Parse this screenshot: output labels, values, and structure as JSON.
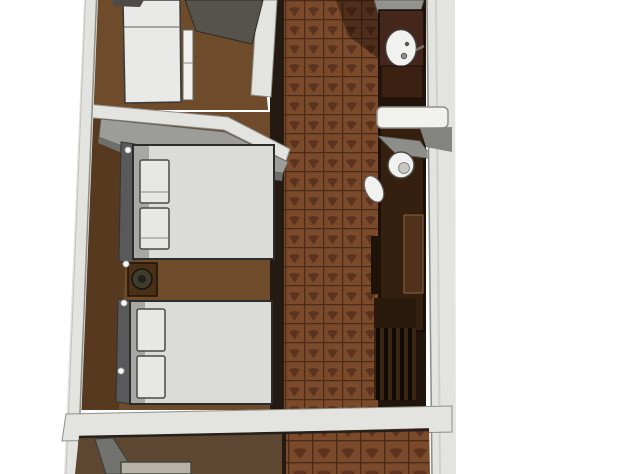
{
  "scene": {
    "kind": "3d-floorplan-top-view-render",
    "description": "Soft-focus axonometric 3D render of a narrow apartment floor plan, cropped top and bottom. Two bedrooms with white double beds on the left, a dark herringbone-tiled corridor in the center, bathroom fixtures and dark wood counters along the right wall, and a partially visible room at the bottom. No text is rendered in the image.",
    "objects": [
      "left-exterior-wall",
      "right-exterior-wall",
      "interior-divider-wall",
      "chamfered-corner-wall",
      "bottom-horizontal-wall",
      "top-room-single-bed",
      "cabinet-door-panel",
      "side-unit-panel",
      "corner-wardrobe-gray",
      "double-bed-1",
      "bed-1-pillows",
      "headboard-1",
      "nightstand",
      "potted-plant",
      "double-bed-2",
      "bed-2-pillows",
      "headboard-2",
      "wall-dots",
      "tiled-corridor-floor",
      "wood-room-floor",
      "vanity-counter",
      "round-sink",
      "toilet",
      "bidet",
      "white-door-panel",
      "tall-dark-counter",
      "slatted-shelf-or-stairs",
      "bottom-room-floor",
      "door-swing-wedge",
      "cropped-side-table"
    ]
  },
  "palette": {
    "background": "#ffffff",
    "wall": "#e3e3e0",
    "wall_edge": "#8f8f8a",
    "floor_wood": "#6e4b2a",
    "floor_wood_bottom": "#5d4730",
    "tile_base": "#7b4a2b",
    "tile_motif": "#572f1c",
    "tile_grout": "#4a2c18",
    "dark_band": "#241a11",
    "backdrop_dark": "#20140c",
    "counter_dark": "#35200f",
    "vanity_wood": "#44271a",
    "fixture_white": "#f1f1ef",
    "duvet": "#dbdbd9",
    "pillow": "#e7e7e5",
    "headboard": "#59595b",
    "gray_furniture": "#9c9c98",
    "gray_furniture_dark": "#6e6e6a",
    "door_panel_gray": "#56524c",
    "nightstand_wood": "#4a3017",
    "plant_green": "#3f3d2e",
    "slat_dark": "#100a04"
  }
}
